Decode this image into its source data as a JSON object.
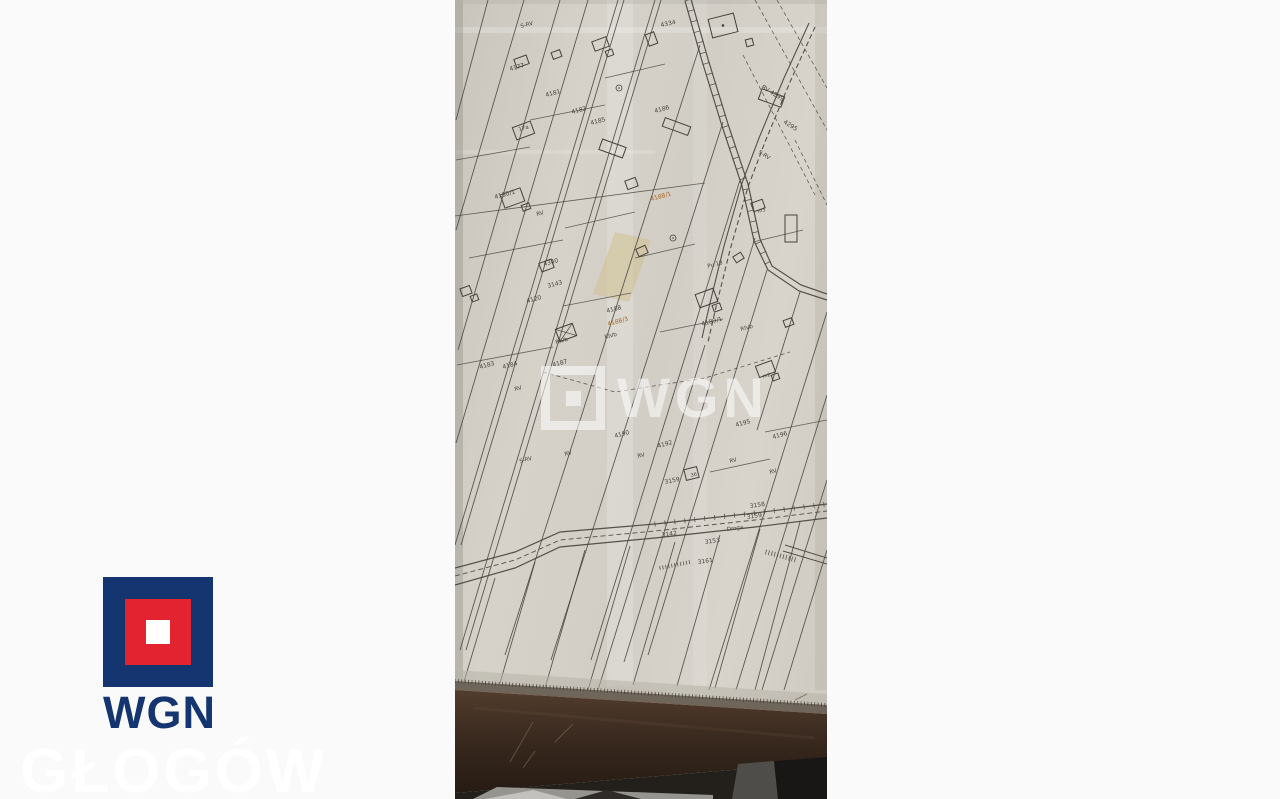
{
  "page": {
    "background": "#fafafa"
  },
  "watermarks": {
    "map": "WGN",
    "corner": "GŁOGÓW"
  },
  "logo": {
    "text": "WGN",
    "navy": "#14356f",
    "red": "#e32430",
    "white": "#ffffff"
  },
  "map": {
    "paper_color": "#d5d1c9",
    "ink": "#45423c",
    "highlight": "#a4641c",
    "patches": [
      {
        "type": "rect",
        "x": 152,
        "y": 0,
        "w": 26,
        "h": 686,
        "fill": "#ffffff",
        "op": 0.18
      },
      {
        "type": "rect",
        "x": 238,
        "y": 0,
        "w": 14,
        "h": 686,
        "fill": "#ffffff",
        "op": 0.1
      },
      {
        "type": "rect",
        "x": 0,
        "y": 27,
        "w": 372,
        "h": 6,
        "fill": "#ffffff",
        "op": 0.22
      },
      {
        "type": "rect",
        "x": 0,
        "y": 150,
        "w": 200,
        "h": 4,
        "fill": "#ffffff",
        "op": 0.15
      },
      {
        "type": "poly",
        "pts": [
          [
            160,
            232
          ],
          [
            196,
            240
          ],
          [
            174,
            302
          ],
          [
            138,
            294
          ]
        ],
        "fill": "#cfc08a",
        "op": 0.5
      },
      {
        "type": "rect",
        "x": 0,
        "y": 0,
        "w": 8,
        "h": 690,
        "fill": "#8a867e",
        "op": 0.35
      },
      {
        "type": "rect",
        "x": 360,
        "y": 0,
        "w": 12,
        "h": 690,
        "fill": "#a9a59d",
        "op": 0.25
      },
      {
        "type": "rect",
        "x": 0,
        "y": 0,
        "w": 372,
        "h": 4,
        "fill": "#b5b1a9",
        "op": 0.4
      }
    ],
    "parcel_lines": [
      [
        33,
        0,
        1,
        120
      ],
      [
        69,
        0,
        1,
        230
      ],
      [
        105,
        0,
        3,
        350
      ],
      [
        133,
        0,
        1,
        443
      ],
      [
        163,
        0,
        0,
        545
      ],
      [
        169,
        0,
        6,
        545
      ],
      [
        200,
        0,
        5,
        650
      ],
      [
        206,
        0,
        11,
        650
      ],
      [
        245,
        45,
        50,
        655
      ],
      [
        268,
        122,
        96,
        660
      ],
      [
        285,
        180,
        136,
        660
      ],
      [
        300,
        238,
        169,
        662
      ],
      [
        312,
        270,
        193,
        655
      ],
      [
        250,
        345,
        143,
        690
      ],
      [
        372,
        312,
        254,
        690
      ],
      [
        372,
        395,
        281,
        690
      ],
      [
        372,
        480,
        307,
        690
      ],
      [
        372,
        550,
        329,
        690
      ],
      [
        345,
        292,
        302,
        430
      ],
      [
        40,
        578,
        8,
        685
      ],
      [
        80,
        562,
        45,
        683
      ],
      [
        130,
        550,
        90,
        688
      ],
      [
        175,
        546,
        133,
        690
      ],
      [
        220,
        542,
        178,
        685
      ],
      [
        265,
        535,
        222,
        686
      ],
      [
        305,
        529,
        260,
        688
      ],
      [
        345,
        522,
        300,
        690
      ]
    ],
    "cross_lines": [
      [
        1,
        160,
        75,
        147
      ],
      [
        14,
        258,
        108,
        240
      ],
      [
        2,
        365,
        98,
        347
      ],
      [
        75,
        120,
        150,
        105
      ],
      [
        110,
        228,
        180,
        212
      ],
      [
        150,
        78,
        210,
        64
      ],
      [
        108,
        306,
        176,
        293
      ],
      [
        180,
        258,
        240,
        244
      ],
      [
        205,
        332,
        268,
        319
      ],
      [
        298,
        242,
        348,
        230
      ],
      [
        310,
        432,
        372,
        420
      ],
      [
        255,
        472,
        315,
        459
      ],
      [
        0,
        216,
        250,
        183
      ]
    ],
    "dashed_lines": [
      [
        300,
        0,
        372,
        130
      ],
      [
        288,
        55,
        360,
        195
      ],
      [
        322,
        0,
        372,
        88
      ],
      [
        340,
        140,
        372,
        205
      ]
    ],
    "dashed_polylines": [
      [
        [
          88,
          372
        ],
        [
          160,
          392
        ],
        [
          250,
          378
        ],
        [
          335,
          352
        ]
      ]
    ],
    "roads": [
      {
        "pts": [
          [
            236,
            -1
          ],
          [
            253,
            59
          ],
          [
            273,
            124
          ],
          [
            293,
            184
          ],
          [
            305,
            239
          ],
          [
            317,
            266
          ],
          [
            346,
            285
          ],
          [
            372,
            294
          ]
        ],
        "w": 1.2
      },
      {
        "pts": [
          [
            230,
            1
          ],
          [
            247,
            61
          ],
          [
            267,
            126
          ],
          [
            287,
            186
          ],
          [
            299,
            241
          ],
          [
            313,
            270
          ],
          [
            344,
            291
          ],
          [
            372,
            300
          ]
        ],
        "w": 1.2
      },
      {
        "pts": [
          [
            354,
            23
          ],
          [
            329,
            78
          ],
          [
            304,
            138
          ],
          [
            287,
            183
          ],
          [
            269,
            246
          ],
          [
            255,
            303
          ],
          [
            247,
            338
          ]
        ],
        "w": 1.1
      },
      {
        "pts": [
          [
            360,
            27
          ],
          [
            335,
            82
          ],
          [
            310,
            142
          ],
          [
            293,
            187
          ],
          [
            275,
            250
          ],
          [
            261,
            307
          ],
          [
            253,
            342
          ]
        ],
        "w": 1.1,
        "dash": true
      },
      {
        "pts": [
          [
            0,
            568
          ],
          [
            60,
            552
          ],
          [
            105,
            532
          ],
          [
            200,
            524
          ],
          [
            300,
            513
          ],
          [
            372,
            504
          ]
        ],
        "w": 1.2
      },
      {
        "pts": [
          [
            0,
            585
          ],
          [
            60,
            568
          ],
          [
            105,
            547
          ],
          [
            200,
            538
          ],
          [
            300,
            527
          ],
          [
            372,
            518
          ]
        ],
        "w": 1.2
      },
      {
        "pts": [
          [
            0,
            576
          ],
          [
            60,
            560
          ],
          [
            105,
            540
          ],
          [
            200,
            531
          ],
          [
            300,
            520
          ],
          [
            372,
            511
          ]
        ],
        "w": 0.9,
        "dash": true
      },
      {
        "pts": [
          [
            330,
            545
          ],
          [
            372,
            558
          ]
        ],
        "w": 1
      },
      {
        "pts": [
          [
            328,
            551
          ],
          [
            372,
            564
          ]
        ],
        "w": 1
      }
    ],
    "tick_paths": [
      {
        "pts": [
          [
            233,
            0
          ],
          [
            250,
            60
          ],
          [
            270,
            125
          ],
          [
            290,
            185
          ],
          [
            302,
            240
          ],
          [
            315,
            268
          ]
        ],
        "sp": 11,
        "len": 7
      },
      {
        "pts": [
          [
            200,
            524
          ],
          [
            300,
            513
          ],
          [
            372,
            504
          ]
        ],
        "sp": 10,
        "len": 5
      },
      {
        "pts": [
          [
            311,
            552
          ],
          [
            341,
            560
          ]
        ],
        "sp": 3,
        "len": 5
      },
      {
        "pts": [
          [
            205,
            568
          ],
          [
            235,
            562
          ]
        ],
        "sp": 3,
        "len": 4
      }
    ],
    "ruler_ticks": {
      "pts": [
        [
          0,
          681
        ],
        [
          372,
          705
        ]
      ],
      "sp": 3.4,
      "len": 4,
      "color": "#3b362c"
    },
    "buildings": [
      {
        "x": 60,
        "y": 57,
        "w": 13,
        "h": 9,
        "r": -20
      },
      {
        "x": 97,
        "y": 51,
        "w": 9,
        "h": 7,
        "r": -20
      },
      {
        "x": 138,
        "y": 39,
        "w": 15,
        "h": 10,
        "r": -20
      },
      {
        "x": 151,
        "y": 50,
        "w": 7,
        "h": 6,
        "r": -20
      },
      {
        "x": 192,
        "y": 33,
        "w": 9,
        "h": 12,
        "r": -20
      },
      {
        "x": 255,
        "y": 16,
        "w": 26,
        "h": 19,
        "r": -14,
        "dot": true
      },
      {
        "x": 291,
        "y": 39,
        "w": 7,
        "h": 7,
        "r": -14
      },
      {
        "x": 311,
        "y": 86,
        "w": 11,
        "h": 24,
        "r": -70
      },
      {
        "x": 59,
        "y": 124,
        "w": 19,
        "h": 13,
        "r": -20
      },
      {
        "x": 47,
        "y": 191,
        "w": 21,
        "h": 14,
        "r": -20
      },
      {
        "x": 67,
        "y": 204,
        "w": 8,
        "h": 6,
        "r": -20
      },
      {
        "x": 152,
        "y": 136,
        "w": 11,
        "h": 25,
        "r": -70
      },
      {
        "x": 217,
        "y": 113,
        "w": 9,
        "h": 27,
        "r": -70
      },
      {
        "x": 171,
        "y": 179,
        "w": 11,
        "h": 9,
        "r": -20
      },
      {
        "x": 85,
        "y": 261,
        "w": 13,
        "h": 9,
        "r": -20
      },
      {
        "x": 102,
        "y": 326,
        "w": 18,
        "h": 13,
        "r": -20,
        "cross": true
      },
      {
        "x": 6,
        "y": 287,
        "w": 10,
        "h": 8,
        "r": -20
      },
      {
        "x": 16,
        "y": 295,
        "w": 7,
        "h": 6,
        "r": -20
      },
      {
        "x": 242,
        "y": 291,
        "w": 19,
        "h": 14,
        "r": -20
      },
      {
        "x": 258,
        "y": 304,
        "w": 8,
        "h": 7,
        "r": -20
      },
      {
        "x": 297,
        "y": 201,
        "w": 12,
        "h": 9,
        "r": -20
      },
      {
        "x": 302,
        "y": 363,
        "w": 17,
        "h": 12,
        "r": -20
      },
      {
        "x": 317,
        "y": 374,
        "w": 7,
        "h": 6,
        "r": -20
      },
      {
        "x": 329,
        "y": 319,
        "w": 9,
        "h": 7,
        "r": -20
      },
      {
        "x": 230,
        "y": 468,
        "w": 13,
        "h": 11,
        "r": -14
      },
      {
        "x": 182,
        "y": 247,
        "w": 10,
        "h": 8,
        "r": -24
      },
      {
        "x": 279,
        "y": 254,
        "w": 9,
        "h": 7,
        "r": -32
      },
      {
        "x": 330,
        "y": 215,
        "w": 12,
        "h": 27,
        "r": 0
      }
    ],
    "survey_marks": [
      [
        218,
        238
      ],
      [
        164,
        88
      ]
    ],
    "labels": [
      {
        "t": "S-RV",
        "x": 66,
        "y": 28,
        "r": -15,
        "s": 5.5
      },
      {
        "t": "4334",
        "x": 206,
        "y": 27,
        "r": -12
      },
      {
        "t": "4177",
        "x": 55,
        "y": 71,
        "r": -15
      },
      {
        "t": "4181",
        "x": 91,
        "y": 97,
        "r": -15
      },
      {
        "t": "4182",
        "x": 117,
        "y": 114,
        "r": -15
      },
      {
        "t": "4185",
        "x": 136,
        "y": 125,
        "r": -15
      },
      {
        "t": "4186",
        "x": 200,
        "y": 113,
        "r": -15
      },
      {
        "t": "RV 4299",
        "x": 306,
        "y": 88,
        "r": 32
      },
      {
        "t": "4295",
        "x": 328,
        "y": 123,
        "r": 32
      },
      {
        "t": "S-RV",
        "x": 303,
        "y": 153,
        "r": 32,
        "s": 5.5
      },
      {
        "t": "17a",
        "x": 64,
        "y": 131,
        "r": -15,
        "s": 5.5
      },
      {
        "t": "4180/1",
        "x": 40,
        "y": 199,
        "r": -15
      },
      {
        "t": "RV",
        "x": 82,
        "y": 216,
        "r": -15,
        "s": 5.5
      },
      {
        "t": "4188/1",
        "x": 196,
        "y": 201,
        "r": -15,
        "c": "#a4641c"
      },
      {
        "t": "m3",
        "x": 303,
        "y": 213,
        "r": -15,
        "s": 5
      },
      {
        "t": "4340",
        "x": 89,
        "y": 266,
        "r": -15
      },
      {
        "t": "3143",
        "x": 93,
        "y": 288,
        "r": -15
      },
      {
        "t": "Pu 18",
        "x": 253,
        "y": 268,
        "r": -15,
        "s": 5.5
      },
      {
        "t": "4120",
        "x": 72,
        "y": 303,
        "r": -15
      },
      {
        "t": "4188",
        "x": 152,
        "y": 313,
        "r": -15
      },
      {
        "t": "4188/3",
        "x": 153,
        "y": 326,
        "r": -15,
        "c": "#a4641c"
      },
      {
        "t": "RIVb",
        "x": 150,
        "y": 339,
        "r": -15,
        "s": 5.5
      },
      {
        "t": "4189/1",
        "x": 247,
        "y": 326,
        "r": -15
      },
      {
        "t": "RIVb",
        "x": 286,
        "y": 331,
        "r": -15,
        "s": 5.5
      },
      {
        "t": "RIVb",
        "x": 101,
        "y": 344,
        "r": -15,
        "s": 5.5
      },
      {
        "t": "4183",
        "x": 25,
        "y": 369,
        "r": -15
      },
      {
        "t": "4184",
        "x": 48,
        "y": 369,
        "r": -15
      },
      {
        "t": "4187",
        "x": 98,
        "y": 367,
        "r": -15
      },
      {
        "t": "m2",
        "x": 308,
        "y": 378,
        "r": -15,
        "s": 5
      },
      {
        "t": "RV",
        "x": 60,
        "y": 391,
        "r": -15,
        "s": 5.5
      },
      {
        "t": "4195",
        "x": 281,
        "y": 427,
        "r": -15
      },
      {
        "t": "4196",
        "x": 318,
        "y": 439,
        "r": -15
      },
      {
        "t": "4190",
        "x": 160,
        "y": 438,
        "r": -15
      },
      {
        "t": "4192",
        "x": 203,
        "y": 448,
        "r": -15
      },
      {
        "t": "RV",
        "x": 110,
        "y": 456,
        "r": -15,
        "s": 5.5
      },
      {
        "t": "RV",
        "x": 183,
        "y": 458,
        "r": -15,
        "s": 5.5
      },
      {
        "t": "RV",
        "x": 275,
        "y": 463,
        "r": -15,
        "s": 5.5
      },
      {
        "t": "S-RV",
        "x": 65,
        "y": 463,
        "r": -15,
        "s": 5.5
      },
      {
        "t": "RV",
        "x": 315,
        "y": 474,
        "r": -15,
        "s": 5.5
      },
      {
        "t": "3159",
        "x": 210,
        "y": 484,
        "r": -12
      },
      {
        "t": "36",
        "x": 236,
        "y": 477,
        "r": -14,
        "s": 5
      },
      {
        "t": "3158",
        "x": 295,
        "y": 508,
        "r": -8
      },
      {
        "t": "3159",
        "x": 292,
        "y": 519,
        "r": -8
      },
      {
        "t": "Droga",
        "x": 272,
        "y": 531,
        "r": -8,
        "s": 5.5
      },
      {
        "t": "3142",
        "x": 207,
        "y": 537,
        "r": -8
      },
      {
        "t": "3153",
        "x": 250,
        "y": 544,
        "r": -8
      },
      {
        "t": "3161",
        "x": 243,
        "y": 564,
        "r": -8
      }
    ]
  },
  "desk": {
    "pre_edge": "#b7b2a8",
    "ruler": "#6e665b",
    "wood_top": "#523d2d",
    "wood_mid": "#3a2a1f",
    "wood_bottom": "#261b13",
    "wood_highlight": "#7a6350",
    "scratch": "#7a614c",
    "floor_dark": "#23201c",
    "floor_light": "#96948f",
    "floor_bright": "#c3c1bd",
    "floor_shadow": "#2e2b28",
    "slab": "#4f4d4a",
    "floor_far": "#191715"
  }
}
